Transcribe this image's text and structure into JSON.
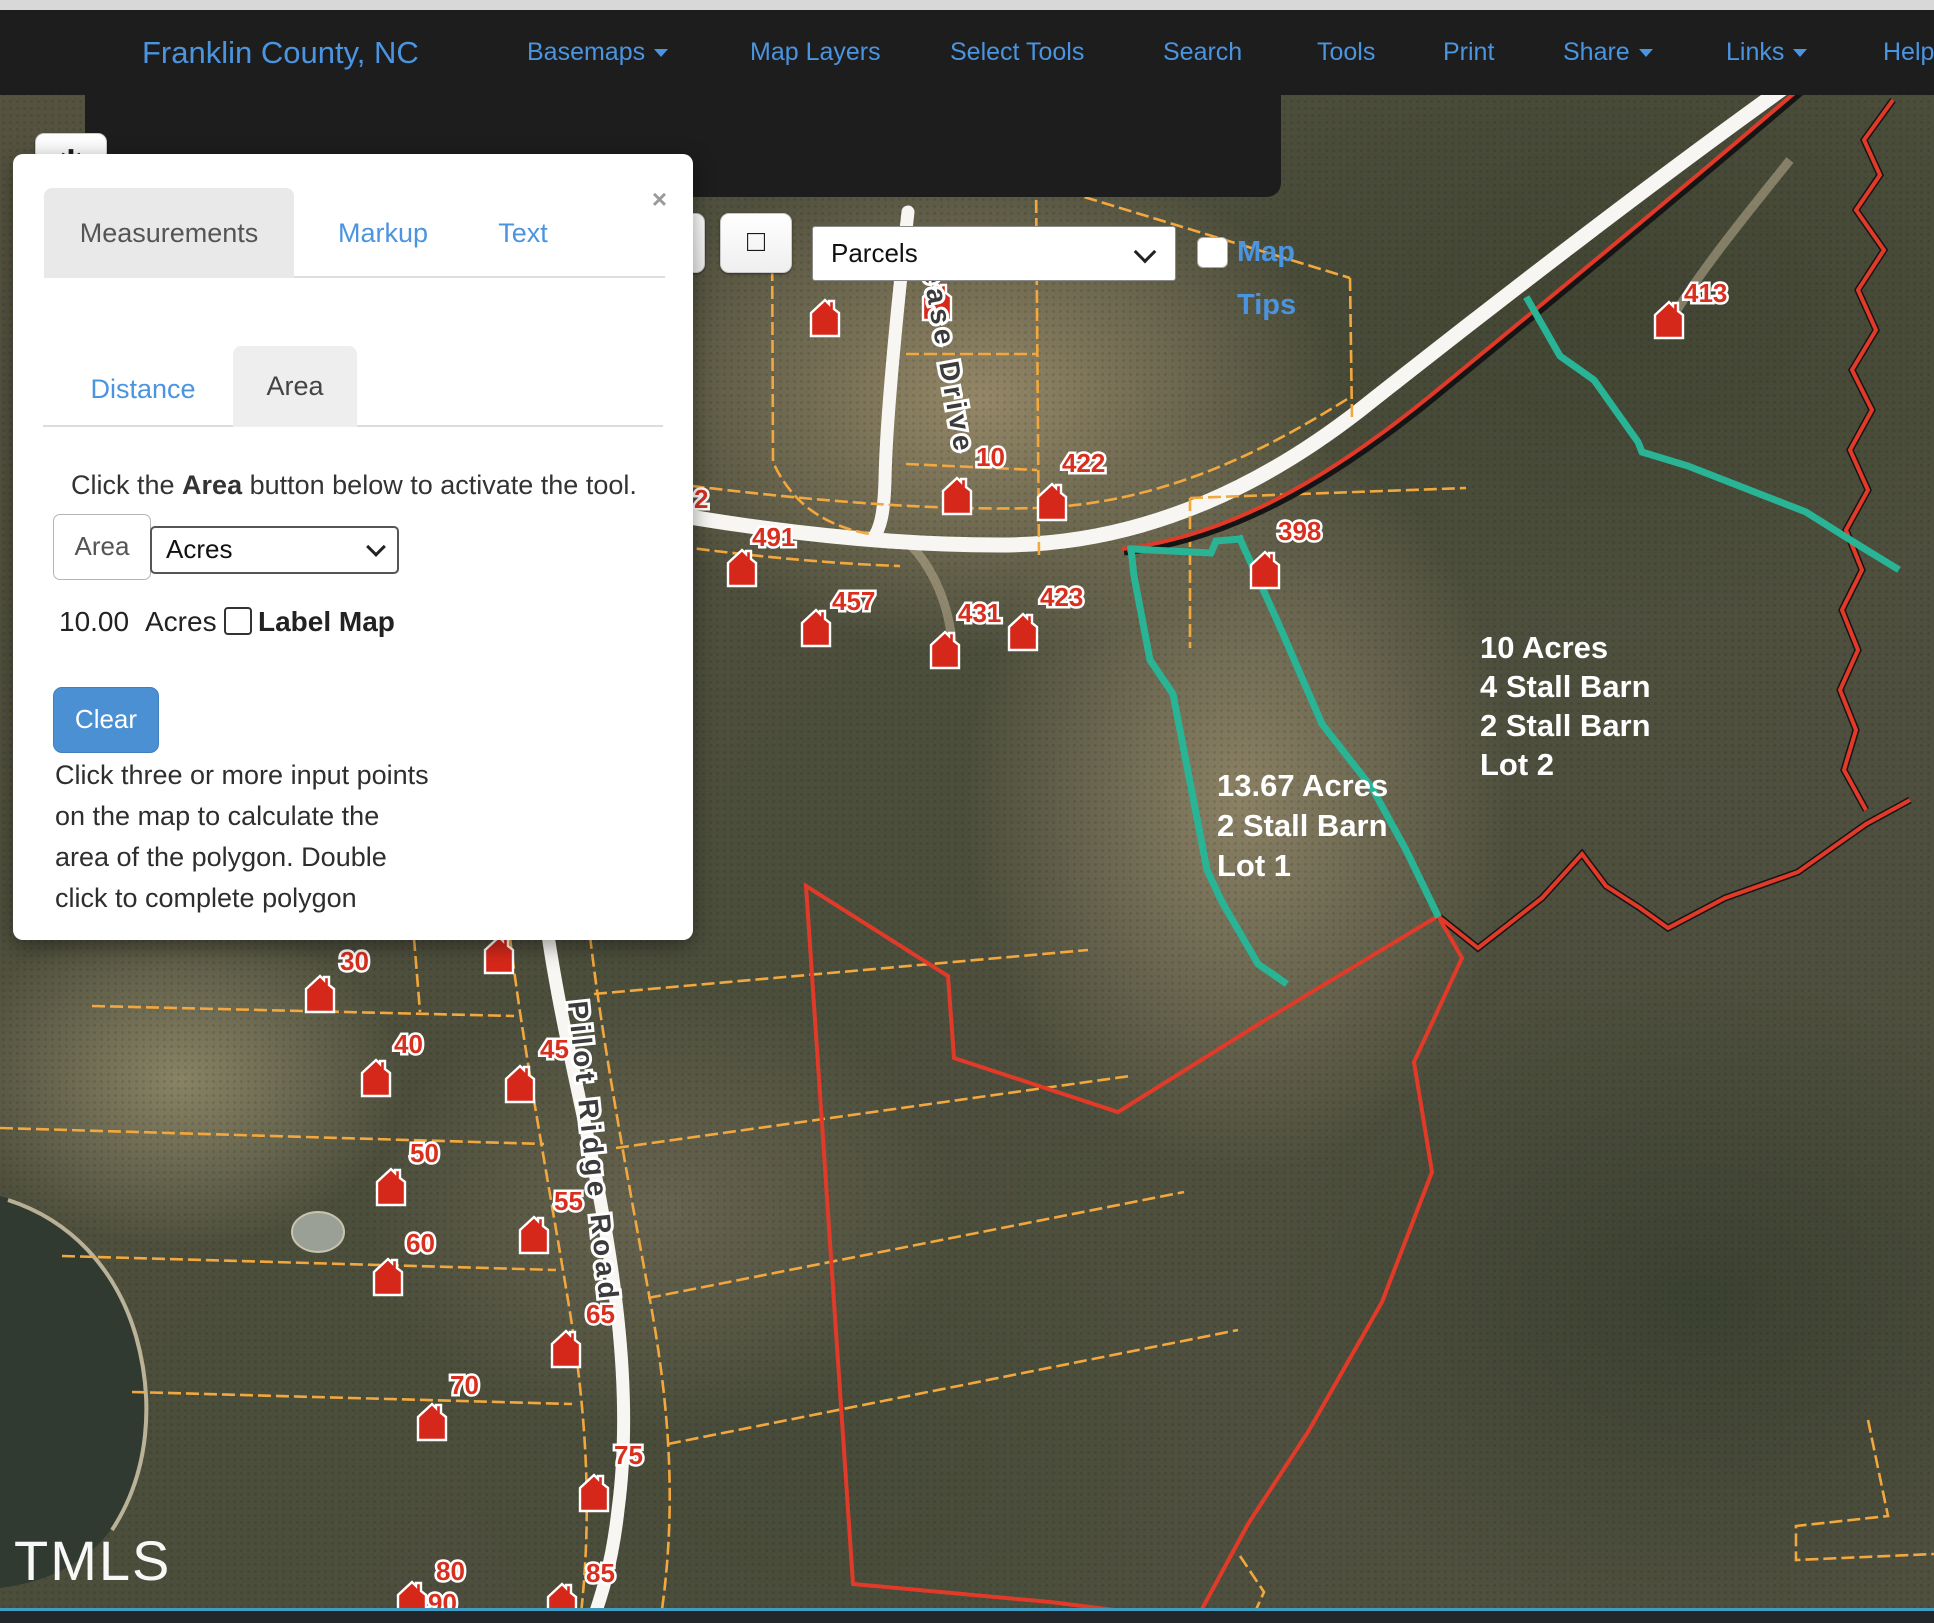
{
  "header": {
    "title": "Franklin County, NC",
    "items": [
      {
        "label": "Basemaps",
        "caret": true
      },
      {
        "label": "Map Layers",
        "caret": false
      },
      {
        "label": "Select Tools",
        "caret": false
      },
      {
        "label": "Search",
        "caret": false
      },
      {
        "label": "Tools",
        "caret": false
      },
      {
        "label": "Print",
        "caret": false
      },
      {
        "label": "Share",
        "caret": true
      },
      {
        "label": "Links",
        "caret": true
      },
      {
        "label": "Help",
        "caret": false
      }
    ]
  },
  "toolbar": {
    "buttons": [
      {
        "name": "tools",
        "glyph": "✱"
      },
      {
        "name": "zoom-in",
        "glyph": "⊕"
      },
      {
        "name": "zoom-out",
        "glyph": "⊖"
      },
      {
        "name": "identify-pointer",
        "glyph": "☝",
        "active": true
      },
      {
        "name": "previous-extent",
        "glyph": "◀"
      },
      {
        "name": "next-extent",
        "glyph": "▶"
      },
      {
        "name": "info",
        "glyph": "ⓘ"
      },
      {
        "name": "select-box",
        "glyph": "□"
      }
    ],
    "layer_select_value": "Parcels",
    "map_tips_label": "Map Tips"
  },
  "panel": {
    "close_glyph": "×",
    "tabs": {
      "measurements": "Measurements",
      "markup": "Markup",
      "text": "Text"
    },
    "subtabs": {
      "distance": "Distance",
      "area": "Area"
    },
    "instruction": {
      "pre": "Click the ",
      "bold": "Area",
      "post": " button below to activate the tool."
    },
    "area_button_label": "Area",
    "units_value": "Acres",
    "result_value": "10.00",
    "result_units": "Acres",
    "label_map_label": "Label Map",
    "clear_label": "Clear",
    "help_lines": [
      "Click three or more input points",
      "on the map to calculate the",
      "area of the polygon. Double",
      "click to complete polygon"
    ]
  },
  "map": {
    "watermark": "TMLS",
    "road_labels": [
      {
        "text": "Alease Drive",
        "x": 916,
        "y": 232,
        "rotate": 80
      },
      {
        "text": "Pilot Ridge Road",
        "x": 568,
        "y": 1002,
        "rotate": 84
      }
    ],
    "annotations": [
      {
        "x": 1217,
        "y": 796,
        "lh": 40,
        "lines": [
          "13.67 Acres",
          "2 Stall Barn",
          "Lot 1"
        ]
      },
      {
        "x": 1480,
        "y": 658,
        "lh": 39,
        "lines": [
          "10 Acres",
          "4 Stall Barn",
          "2 Stall Barn",
          "Lot 2"
        ]
      }
    ],
    "markers": [
      {
        "icon": true,
        "label": "",
        "x": 825,
        "y": 318
      },
      {
        "icon": true,
        "label": "20",
        "x": 937,
        "y": 302,
        "lx": 952,
        "ly": 272
      },
      {
        "icon": true,
        "label": "10",
        "x": 957,
        "y": 496,
        "lx": 976,
        "ly": 466
      },
      {
        "icon": true,
        "label": "422",
        "x": 1052,
        "y": 502,
        "lx": 1062,
        "ly": 472
      },
      {
        "icon": true,
        "label": "398",
        "x": 1265,
        "y": 570,
        "lx": 1278,
        "ly": 540
      },
      {
        "icon": true,
        "label": "457",
        "x": 816,
        "y": 628,
        "lx": 832,
        "ly": 610
      },
      {
        "icon": true,
        "label": "431",
        "x": 945,
        "y": 650,
        "lx": 958,
        "ly": 622
      },
      {
        "icon": true,
        "label": "491",
        "x": 742,
        "y": 568,
        "lx": 752,
        "ly": 546
      },
      {
        "icon": true,
        "label": "423",
        "x": 1023,
        "y": 632,
        "lx": 1040,
        "ly": 606
      },
      {
        "icon": true,
        "label": "413",
        "x": 1669,
        "y": 320,
        "lx": 1684,
        "ly": 302
      },
      {
        "icon": false,
        "label": "2",
        "lx": 694,
        "ly": 508
      },
      {
        "icon": true,
        "label": "",
        "x": 499,
        "y": 955
      },
      {
        "icon": true,
        "label": "30",
        "x": 320,
        "y": 994,
        "lx": 340,
        "ly": 970
      },
      {
        "icon": true,
        "label": "40",
        "x": 376,
        "y": 1078,
        "lx": 394,
        "ly": 1053
      },
      {
        "icon": true,
        "label": "45",
        "x": 520,
        "y": 1084,
        "lx": 540,
        "ly": 1058
      },
      {
        "icon": true,
        "label": "50",
        "x": 391,
        "y": 1187,
        "lx": 410,
        "ly": 1162
      },
      {
        "icon": true,
        "label": "55",
        "x": 534,
        "y": 1235,
        "lx": 554,
        "ly": 1210
      },
      {
        "icon": true,
        "label": "60",
        "x": 388,
        "y": 1277,
        "lx": 406,
        "ly": 1252
      },
      {
        "icon": true,
        "label": "65",
        "x": 566,
        "y": 1349,
        "lx": 586,
        "ly": 1323
      },
      {
        "icon": true,
        "label": "70",
        "x": 432,
        "y": 1422,
        "lx": 450,
        "ly": 1394
      },
      {
        "icon": true,
        "label": "75",
        "x": 594,
        "y": 1493,
        "lx": 614,
        "ly": 1464
      },
      {
        "icon": true,
        "label": "80",
        "x": 412,
        "y": 1600,
        "lx": 436,
        "ly": 1580
      },
      {
        "icon": true,
        "label": "85",
        "x": 562,
        "y": 1602,
        "lx": 586,
        "ly": 1582
      },
      {
        "icon": false,
        "label": "90",
        "lx": 428,
        "ly": 1612
      }
    ]
  }
}
